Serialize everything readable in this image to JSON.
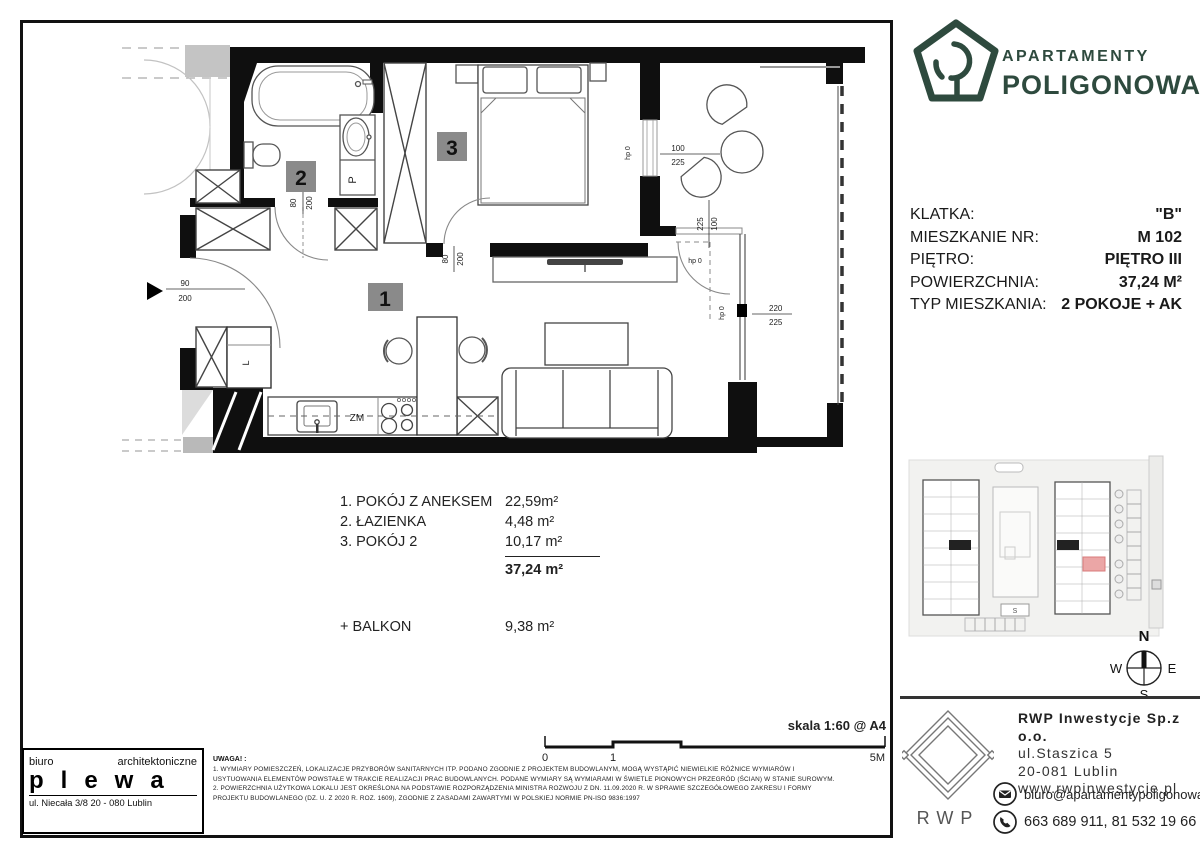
{
  "brand": {
    "line1": "APARTAMENTY",
    "line2": "POLIGONOWA",
    "color": "#2e4a3e"
  },
  "details": {
    "rows": [
      {
        "label": "KLATKA:",
        "value": "\"B\""
      },
      {
        "label": "MIESZKANIE NR:",
        "value": "M  102"
      },
      {
        "label": "PIĘTRO:",
        "value": "PIĘTRO III"
      },
      {
        "label": "POWIERZCHNIA:",
        "value": "37,24 M²"
      },
      {
        "label": "TYP MIESZKANIA:",
        "value": "2 POKOJE + AK"
      }
    ]
  },
  "rooms": {
    "items": [
      {
        "name": "1. POKÓJ Z ANEKSEM",
        "area": "22,59m²"
      },
      {
        "name": "2. ŁAZIENKA",
        "area": "4,48 m²"
      },
      {
        "name": "3. POKÓJ 2",
        "area": "10,17 m²"
      }
    ],
    "total": "37,24 m²",
    "balcony_label": "+ BALKON",
    "balcony_area": "9,38 m²"
  },
  "plan": {
    "badges": {
      "room1": "1",
      "room2": "2",
      "room3": "3"
    },
    "labels": {
      "washer": "P",
      "fridge": "L",
      "dishwasher": "ZM"
    },
    "dims": {
      "d80": "80",
      "d90": "90",
      "d100": "100",
      "d200": "200",
      "d220": "220",
      "d225": "225",
      "hp0": "hp 0"
    }
  },
  "scalebar": {
    "title": "skala 1:60 @ A4",
    "t0": "0",
    "t1": "1",
    "t5": "5M"
  },
  "notes": {
    "title": "UWAGA! :",
    "lines": [
      "1. WYMIARY POMIESZCZEŃ, LOKALIZACJE PRZYBORÓW SANITARNYCH ITP. PODANO ZGODNIE Z PROJEKTEM BUDOWLANYM, MOGĄ WYSTĄPIĆ NIEWIELKIE RÓŻNICE WYMIARÓW I",
      "USYTUOWANIA ELEMENTÓW POWSTAŁE W TRAKCIE REALIZACJI PRAC BUDOWLANYCH. PODANE WYMIARY SĄ WYMIARAMI W ŚWIETLE PIONOWYCH PRZEGRÓD (ŚCIAN) W STANIE SUROWYM.",
      "2. POWIERZCHNIA UŻYTKOWA LOKALU JEST OKREŚLONA NA PODSTAWIE ROZPORZĄDZENIA MINISTRA ROZWOJU Z DN. 11.09.2020 R. W SPRAWIE SZCZEGÓŁOWEGO ZAKRESU I FORMY",
      "PROJEKTU BUDOWLANEGO (DZ. U. Z 2020 R. ROZ. 1609), ZGODNIE Z ZASADAMI ZAWARTYMI W POLSKIEJ NORMIE PN-ISO 9836:1997"
    ]
  },
  "architect": {
    "pre": "biuro",
    "pre2": "architektoniczne",
    "name": "plewa",
    "address": "ul. Niecała 3/8  20 - 080 Lublin"
  },
  "developer": {
    "logo": "RWP",
    "company": "RWP Inwestycje Sp.z o.o.",
    "street": "ul.Staszica 5",
    "city": "20-081 Lublin",
    "web": "www.rwpinwestycje.pl",
    "email": "biuro@apartamentypoligonowa.pl",
    "phones": "663 689 911,  81 532 19 66"
  },
  "compass": {
    "n": "N",
    "e": "E",
    "s": "S",
    "w": "W"
  },
  "site": {
    "marker": "S"
  }
}
